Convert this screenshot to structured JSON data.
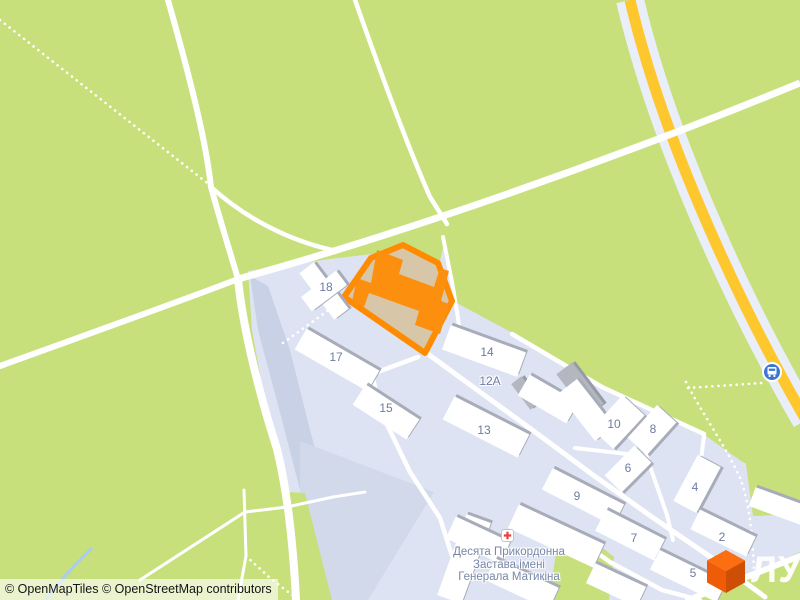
{
  "attribution": {
    "text": "© OpenMapTiles © OpenStreetMap contributors"
  },
  "logo": {
    "text": "ЛУН"
  },
  "poi": {
    "icon": "hospital-cross",
    "name_lines": [
      "Десята Прикордонна",
      "Застава імені",
      "Генерала Матикіна"
    ]
  },
  "bus_stop": {
    "icon": "bus"
  },
  "building_labels": [
    {
      "text": "18",
      "x": 326,
      "y": 287
    },
    {
      "text": "17",
      "x": 336,
      "y": 357
    },
    {
      "text": "15",
      "x": 386,
      "y": 408
    },
    {
      "text": "14",
      "x": 487,
      "y": 352
    },
    {
      "text": "12А",
      "x": 490,
      "y": 381
    },
    {
      "text": "13",
      "x": 484,
      "y": 430
    },
    {
      "text": "10",
      "x": 614,
      "y": 424
    },
    {
      "text": "8",
      "x": 653,
      "y": 429
    },
    {
      "text": "6",
      "x": 628,
      "y": 468
    },
    {
      "text": "9",
      "x": 577,
      "y": 496
    },
    {
      "text": "4",
      "x": 695,
      "y": 487
    },
    {
      "text": "7",
      "x": 634,
      "y": 538
    },
    {
      "text": "2",
      "x": 722,
      "y": 537
    },
    {
      "text": "5",
      "x": 693,
      "y": 573
    }
  ],
  "colors": {
    "greenery": "#c7e07c",
    "residential": "#dde3f2",
    "road_white": "#ffffff",
    "trunk_road_yellow": "#ffc72e",
    "trunk_road_casing": "#e9eef9",
    "highlight_outline": "#ff8b00",
    "highlight_building": "#fd8f0e",
    "highlight_lot": "#d8c6a8",
    "building_fill": "#ffffff",
    "building_shadow": "#a7acb8",
    "label_text": "#6d7ca1",
    "bus_icon_blue": "#3b76d2",
    "hospital_cross_red": "#e8423d",
    "logo_orange": "#f06414"
  }
}
